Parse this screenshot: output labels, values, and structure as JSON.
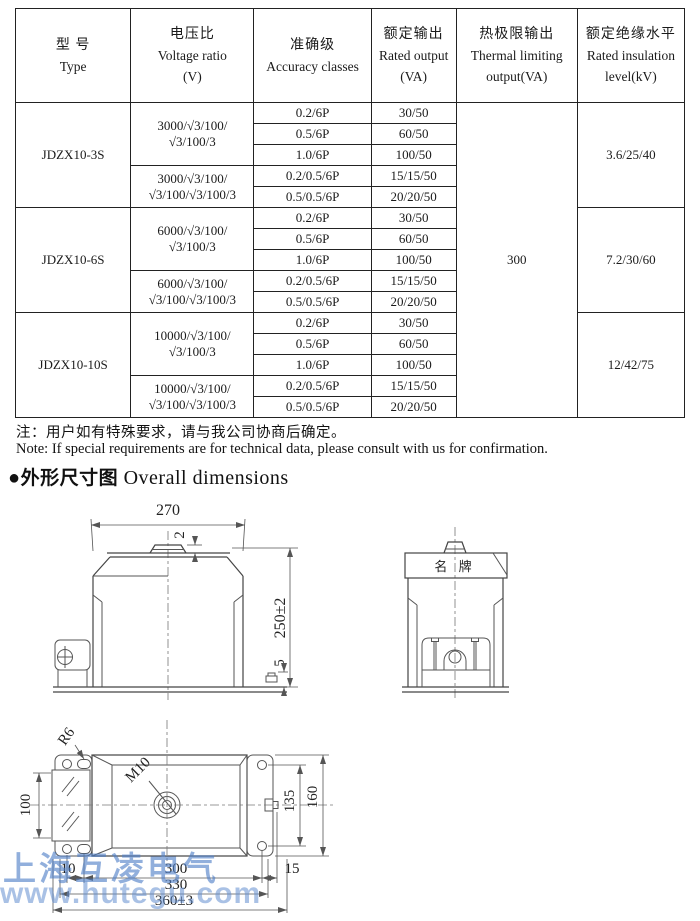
{
  "table": {
    "headers": [
      {
        "zh": "型  号",
        "en": "Type",
        "unit": ""
      },
      {
        "zh": "电压比",
        "en": "Voltage ratio",
        "unit": "(V)"
      },
      {
        "zh": "准确级",
        "en": "Accuracy classes",
        "unit": ""
      },
      {
        "zh": "额定输出",
        "en": "Rated output",
        "unit": "(VA)"
      },
      {
        "zh": "热极限输出",
        "en": "Thermal limiting",
        "unit": "output(VA)"
      },
      {
        "zh": "额定绝缘水平",
        "en": "Rated insulation",
        "unit": "level(kV)"
      }
    ],
    "thermal_limiting_output": "300",
    "blocks": [
      {
        "type": "JDZX10-3S",
        "insulation": "3.6/25/40",
        "groups": [
          {
            "ratio_line1": "3000/√3/100/",
            "ratio_line2": "√3/100/3",
            "rows": [
              [
                "0.2/6P",
                "30/50"
              ],
              [
                "0.5/6P",
                "60/50"
              ],
              [
                "1.0/6P",
                "100/50"
              ]
            ]
          },
          {
            "ratio_line1": "3000/√3/100/",
            "ratio_line2": "√3/100/√3/100/3",
            "rows": [
              [
                "0.2/0.5/6P",
                "15/15/50"
              ],
              [
                "0.5/0.5/6P",
                "20/20/50"
              ]
            ]
          }
        ]
      },
      {
        "type": "JDZX10-6S",
        "insulation": "7.2/30/60",
        "groups": [
          {
            "ratio_line1": "6000/√3/100/",
            "ratio_line2": "√3/100/3",
            "rows": [
              [
                "0.2/6P",
                "30/50"
              ],
              [
                "0.5/6P",
                "60/50"
              ],
              [
                "1.0/6P",
                "100/50"
              ]
            ]
          },
          {
            "ratio_line1": "6000/√3/100/",
            "ratio_line2": "√3/100/√3/100/3",
            "rows": [
              [
                "0.2/0.5/6P",
                "15/15/50"
              ],
              [
                "0.5/0.5/6P",
                "20/20/50"
              ]
            ]
          }
        ]
      },
      {
        "type": "JDZX10-10S",
        "insulation": "12/42/75",
        "groups": [
          {
            "ratio_line1": "10000/√3/100/",
            "ratio_line2": "√3/100/3",
            "rows": [
              [
                "0.2/6P",
                "30/50"
              ],
              [
                "0.5/6P",
                "60/50"
              ],
              [
                "1.0/6P",
                "100/50"
              ]
            ]
          },
          {
            "ratio_line1": "10000/√3/100/",
            "ratio_line2": "√3/100/√3/100/3",
            "rows": [
              [
                "0.2/0.5/6P",
                "15/15/50"
              ],
              [
                "0.5/0.5/6P",
                "20/20/50"
              ]
            ]
          }
        ]
      }
    ]
  },
  "notes": {
    "zh": "注：用户如有特殊要求，请与我公司协商后确定。",
    "en": "Note: If special requirements are for technical data, please consult with us for confirmation."
  },
  "section_title": {
    "bullet": "●",
    "zh": "外形尺寸图",
    "en": " Overall dimensions"
  },
  "drawings": {
    "front_view": {
      "width": "270",
      "height": "250±2",
      "cap_height": "2",
      "base_thickness": "5"
    },
    "side_view": {
      "nameplate": "名  牌"
    },
    "plan_view": {
      "corner_radius": "R6",
      "bolt_thread": "M10",
      "terminal_width": "100",
      "hole_span": "135",
      "plate_width": "160",
      "dim_10": "10",
      "dim_300": "300",
      "dim_15": "15",
      "dim_330": "330",
      "dim_360": "360±3"
    }
  },
  "watermark": {
    "line1": "上海互凌电气",
    "line2": "www.hutegu.com",
    "color": "#4e7ec7"
  }
}
